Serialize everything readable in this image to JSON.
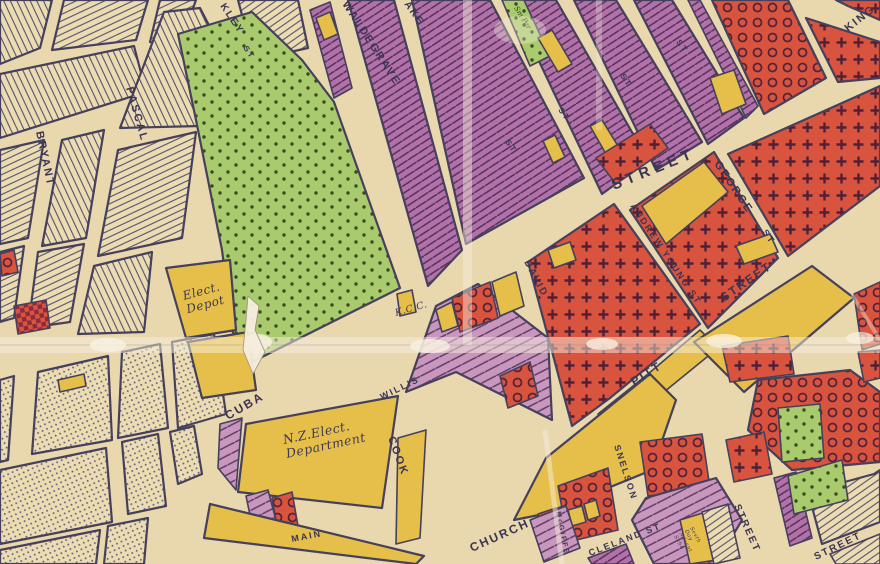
{
  "map": {
    "kind": "vintage-zoning-map",
    "palette": {
      "paper_street": "#e9d7ae",
      "ink_outline": "#45405c",
      "lot_line": "#57506e",
      "park_green": "#a9cb6d",
      "park_dot": "#3c4823",
      "purple_dark": "#b272a8",
      "purple_light": "#c997bd",
      "hatch_ink": "#512d5c",
      "red_zone": "#d8543e",
      "red_ink": "#4f2138",
      "yellow_zone": "#e6bf4b",
      "cream_lots": "#ecdcb2",
      "crease_white": "#f6eede"
    },
    "zones": [
      {
        "name": "green-dotted-reserve",
        "fill": "#a9cb6d",
        "pattern": "dots"
      },
      {
        "name": "purple-dark-hatched",
        "fill": "#b272a8",
        "pattern": "diagonal-hatch"
      },
      {
        "name": "purple-light-hatched",
        "fill": "#c997bd",
        "pattern": "diagonal-hatch"
      },
      {
        "name": "red-cross-pattern",
        "fill": "#d8543e",
        "pattern": "plus-crosses"
      },
      {
        "name": "red-ring-pattern",
        "fill": "#d8543e",
        "pattern": "circles"
      },
      {
        "name": "red-checker",
        "fill": "#d8543e",
        "pattern": "checkerboard"
      },
      {
        "name": "yellow-solid",
        "fill": "#e6bf4b",
        "pattern": "none"
      },
      {
        "name": "uncolored-subdivided-lots",
        "fill": "#ecdcb2",
        "pattern": "fine-lot-lines"
      }
    ]
  },
  "labels": [
    {
      "name": "street-label-bryant",
      "text": "BRYANT",
      "x": 36,
      "y": 132,
      "rot": 78,
      "size": 11,
      "cls": "street"
    },
    {
      "name": "street-label-pascal",
      "text": "PASCAL",
      "x": 126,
      "y": 88,
      "rot": 74,
      "size": 11,
      "cls": "street"
    },
    {
      "name": "street-label-kley",
      "text": "KLEY",
      "x": 220,
      "y": 6,
      "rot": 56,
      "size": 10,
      "cls": "street"
    },
    {
      "name": "street-label-kley-st",
      "text": "ST",
      "x": 243,
      "y": 48,
      "rot": 56,
      "size": 8,
      "cls": "street"
    },
    {
      "name": "street-label-waldegrave",
      "text": "WALDEGRAVE",
      "x": 342,
      "y": 4,
      "rot": 57,
      "size": 11,
      "cls": "street"
    },
    {
      "name": "street-label-ake",
      "text": "AKE",
      "x": 404,
      "y": 4,
      "rot": 55,
      "size": 10,
      "cls": "street"
    },
    {
      "name": "park-strip-note",
      "text": "Sm Par",
      "x": 514,
      "y": 8,
      "rot": 58,
      "size": 7,
      "cls": "handgreen"
    },
    {
      "name": "street-label-st-1",
      "text": "ST",
      "x": 505,
      "y": 142,
      "rot": 55,
      "size": 8,
      "cls": "street"
    },
    {
      "name": "street-label-st-2",
      "text": "ST",
      "x": 558,
      "y": 110,
      "rot": 55,
      "size": 8,
      "cls": "street"
    },
    {
      "name": "street-label-st-3",
      "text": "ST",
      "x": 620,
      "y": 76,
      "rot": 55,
      "size": 8,
      "cls": "street"
    },
    {
      "name": "street-label-st-4",
      "text": "ST",
      "x": 676,
      "y": 42,
      "rot": 55,
      "size": 8,
      "cls": "street"
    },
    {
      "name": "street-label-king",
      "text": "KING",
      "x": 848,
      "y": 32,
      "rot": -38,
      "size": 11,
      "cls": "street"
    },
    {
      "name": "street-label-main-street",
      "text": "STREET",
      "x": 614,
      "y": 190,
      "rot": -22,
      "size": 15,
      "cls": "big"
    },
    {
      "name": "street-label-george",
      "text": "GEORGE",
      "x": 714,
      "y": 164,
      "rot": 56,
      "size": 11,
      "cls": "street"
    },
    {
      "name": "street-label-george-st",
      "text": "ST",
      "x": 762,
      "y": 232,
      "rot": 56,
      "size": 9,
      "cls": "street"
    },
    {
      "name": "street-label-andrew-young",
      "text": "ANDREW YOUNG ST",
      "x": 630,
      "y": 206,
      "rot": 56,
      "size": 9,
      "cls": "street"
    },
    {
      "name": "street-label-david",
      "text": "DAVID",
      "x": 524,
      "y": 262,
      "rot": 62,
      "size": 10,
      "cls": "street"
    },
    {
      "name": "place-label-kcc",
      "text": "K.C.C.",
      "x": 396,
      "y": 316,
      "rot": -16,
      "size": 9.5,
      "cls": "hand"
    },
    {
      "name": "place-label-elect-depot",
      "lines": [
        "Elect.",
        "Depot"
      ],
      "x": 184,
      "y": 300,
      "rot": -15,
      "size": 12,
      "cls": "hand"
    },
    {
      "name": "street-label-cuba",
      "text": "CUBA",
      "x": 228,
      "y": 420,
      "rot": -30,
      "size": 12,
      "cls": "street"
    },
    {
      "name": "street-label-willis",
      "text": "WILLIS",
      "x": 382,
      "y": 400,
      "rot": -26,
      "size": 9,
      "cls": "street"
    },
    {
      "name": "street-label-cook",
      "text": "COOK",
      "x": 388,
      "y": 438,
      "rot": 70,
      "size": 11,
      "cls": "street"
    },
    {
      "name": "place-label-nz-elect",
      "lines": [
        "N.Z.Elect.",
        "Department"
      ],
      "x": 284,
      "y": 444,
      "rot": -12,
      "size": 12.5,
      "cls": "hand"
    },
    {
      "name": "street-label-pitt",
      "text": "PITT",
      "x": 634,
      "y": 386,
      "rot": -32,
      "size": 12,
      "cls": "street"
    },
    {
      "name": "street-label-pitt-street",
      "text": "STREET",
      "x": 724,
      "y": 302,
      "rot": -35,
      "size": 12,
      "cls": "street"
    },
    {
      "name": "street-label-main",
      "text": "MAIN",
      "x": 292,
      "y": 542,
      "rot": -11,
      "size": 9,
      "cls": "street"
    },
    {
      "name": "street-label-church",
      "text": "CHURCH",
      "x": 472,
      "y": 552,
      "rot": -24,
      "size": 12,
      "cls": "street"
    },
    {
      "name": "street-label-snelson",
      "text": "SNELSON",
      "x": 614,
      "y": 446,
      "rot": 72,
      "size": 9,
      "cls": "street"
    },
    {
      "name": "street-label-mcgiffe",
      "text": "McGIFFE",
      "x": 556,
      "y": 512,
      "rot": 78,
      "size": 7,
      "cls": "street"
    },
    {
      "name": "street-label-cleland",
      "text": "CLELAND ST",
      "x": 590,
      "y": 556,
      "rot": -21,
      "size": 9,
      "cls": "street"
    },
    {
      "name": "street-label-street-right",
      "text": "STREET",
      "x": 734,
      "y": 506,
      "rot": 66,
      "size": 10,
      "cls": "street"
    },
    {
      "name": "street-label-street-corner",
      "text": "STREET",
      "x": 816,
      "y": 560,
      "rot": -26,
      "size": 10,
      "cls": "street"
    },
    {
      "name": "place-label-school",
      "lines": [
        "Sevth",
        "Day",
        "Advent",
        "Scho"
      ],
      "x": 690,
      "y": 528,
      "rot": 62,
      "size": 5.2,
      "cls": "hand"
    }
  ]
}
